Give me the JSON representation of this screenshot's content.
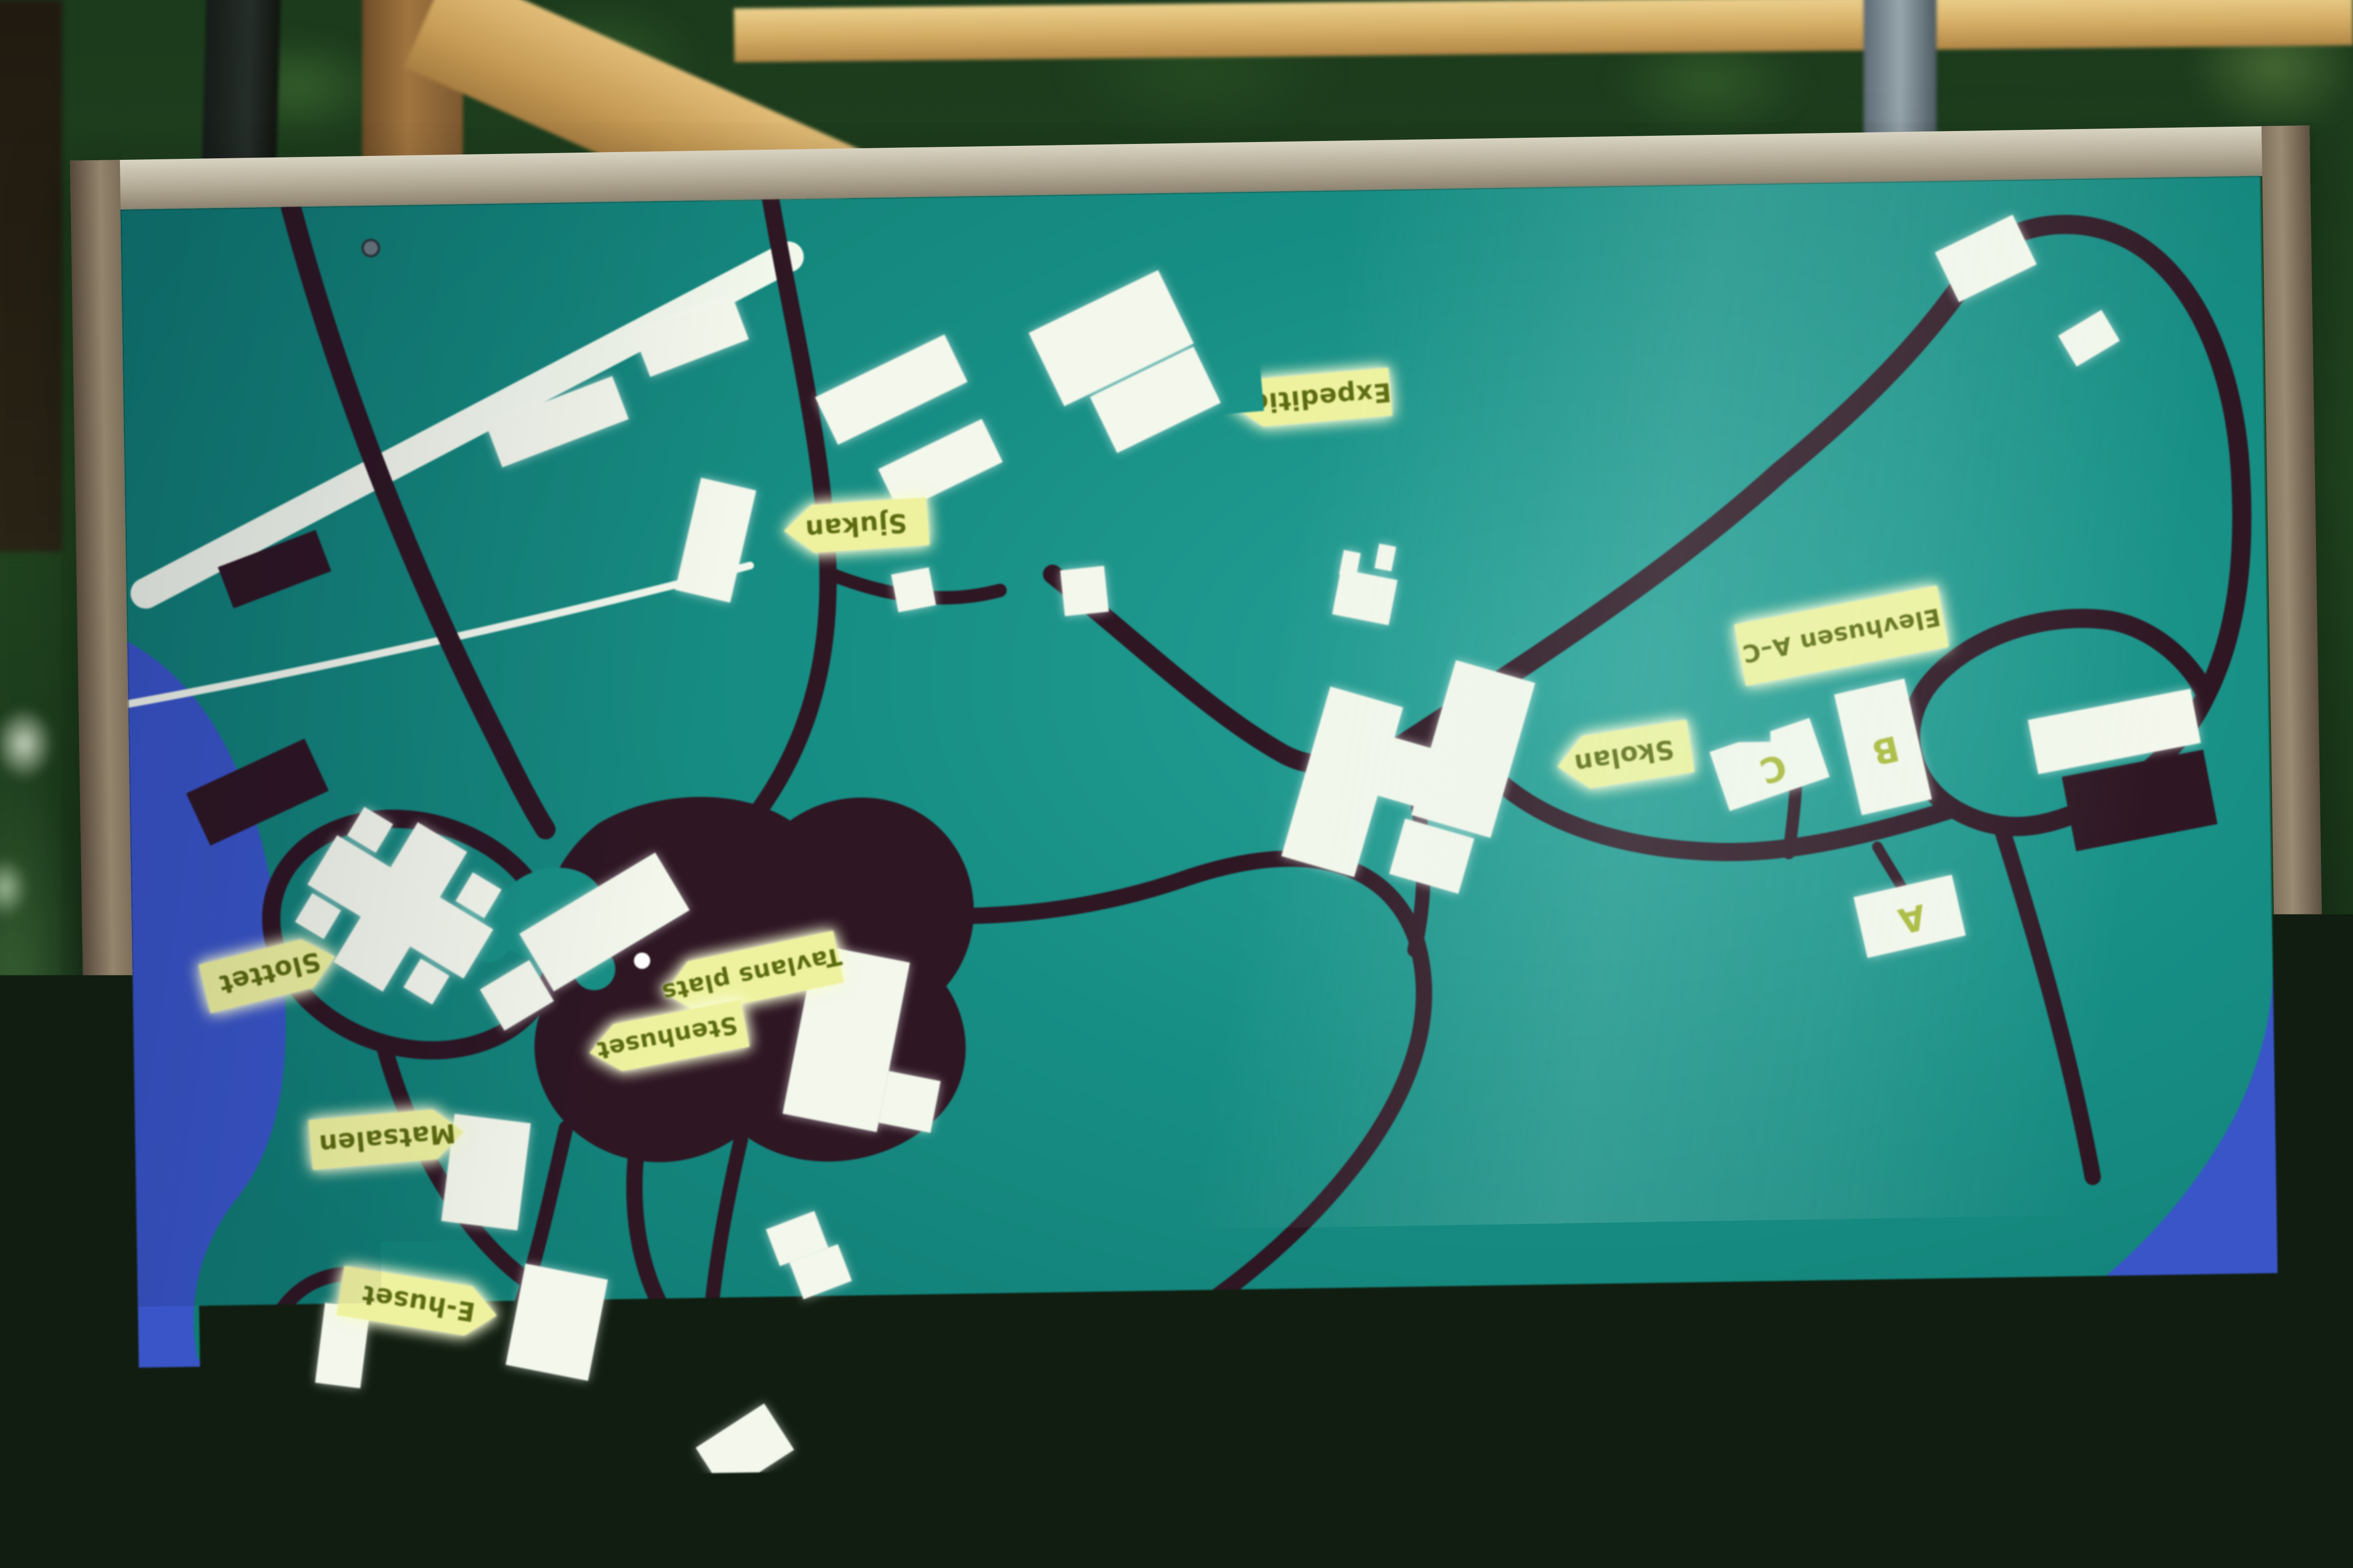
{
  "sign": {
    "map_labels": {
      "expedition": "Expedition",
      "sjukan": "Sjukan",
      "elevhusen": "Elevhusen A–C",
      "skolan": "Skolan",
      "tavlans_plats": "Tavlans plats",
      "stenhuset": "Stenhuset",
      "slottet": "Slottet",
      "matsalen": "Matsalen",
      "e_huset": "E-huset"
    },
    "building_letters": {
      "a": "A",
      "b": "B",
      "c": "C"
    },
    "colors": {
      "board_teal": "#17897f",
      "water_blue": "#3a55c4",
      "water_light": "#5e7ad8",
      "roads_dark": "#2d1623",
      "buildings_white": "#f3f7ec",
      "label_yellow": "#eef2a2",
      "label_text": "#5c6b12",
      "frame_wood": "#a79d8a"
    }
  }
}
